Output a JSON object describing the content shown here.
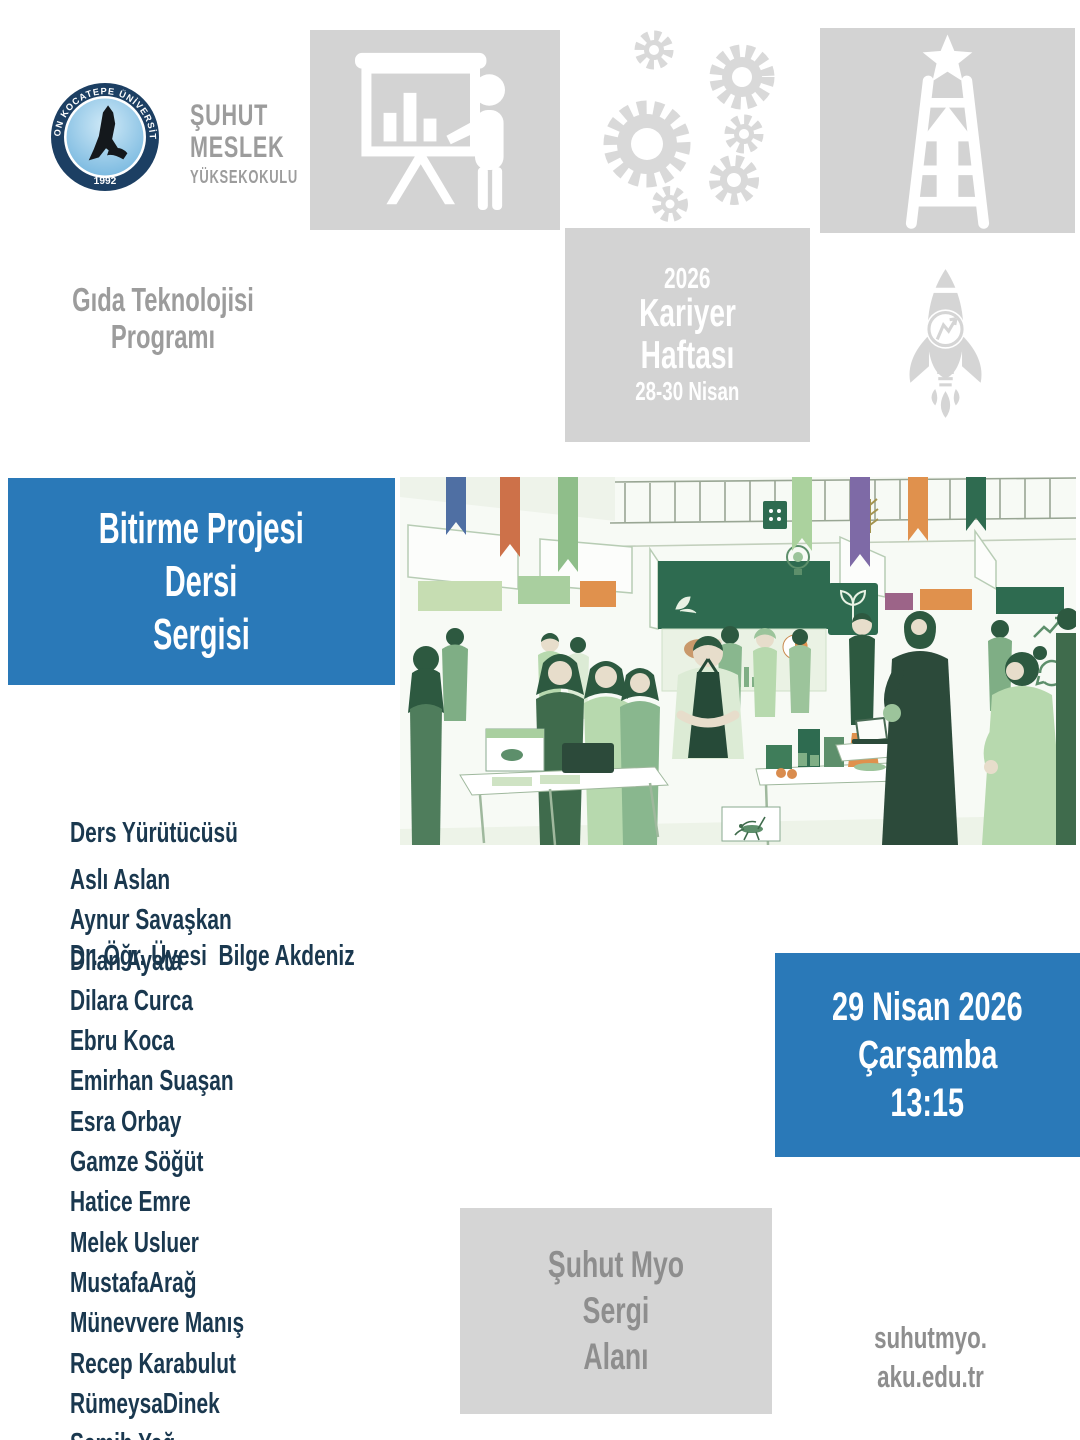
{
  "poster": {
    "logo": {
      "ring_text": "AFYON KOCATEPE ÜNİVERSİTESİ",
      "year": "1992"
    },
    "school": {
      "lines": [
        "ŞUHUT",
        "MESLEK",
        "YÜKSEKOKULU"
      ]
    },
    "program": {
      "lines": [
        "Gıda Teknolojisi",
        "Programı"
      ]
    },
    "career_week": {
      "year": "2026",
      "title": "Kariyer Haftası",
      "dates": "28-30 Nisan"
    },
    "event": {
      "lines": [
        "Bitirme Projesi",
        "Dersi",
        "Sergisi"
      ]
    },
    "instructor": {
      "label": "Ders Yürütücüsü",
      "name": "Dr. Öğr. Üyesi  Bilge Akdeniz"
    },
    "students": [
      "Aslı Aslan",
      "Aynur Savaşkan",
      "Dilan Ayata",
      "Dilara Curca",
      "Ebru Koca",
      "Emirhan Suaşan",
      "Esra Orbay",
      "Gamze Söğüt",
      "Hatice Emre",
      "Melek Usluer",
      "MustafaArağ",
      "Münevvere Manış",
      "Recep Karabulut",
      "RümeysaDinek",
      "Semih Yağ"
    ],
    "schedule": {
      "date": "29 Nisan 2026",
      "day": "Çarşamba",
      "time": "13:15"
    },
    "venue": {
      "lines": [
        "Şuhut Myo",
        "Sergi",
        "Alanı"
      ]
    },
    "website": {
      "lines": [
        "suhutmyo.",
        "aku.edu.tr"
      ]
    },
    "icons": [
      "university-seal-icon",
      "presentation-board-icon",
      "gears-icon",
      "career-ladder-star-icon",
      "rocket-idea-icon",
      "exhibition-illustration"
    ],
    "colors": {
      "accent_blue": "#2A79B8",
      "box_gray": "#D3D3D3",
      "text_gray": "#9C9C9C",
      "text_navy": "#1A384F",
      "illustration_green": "#2E6B50"
    }
  }
}
